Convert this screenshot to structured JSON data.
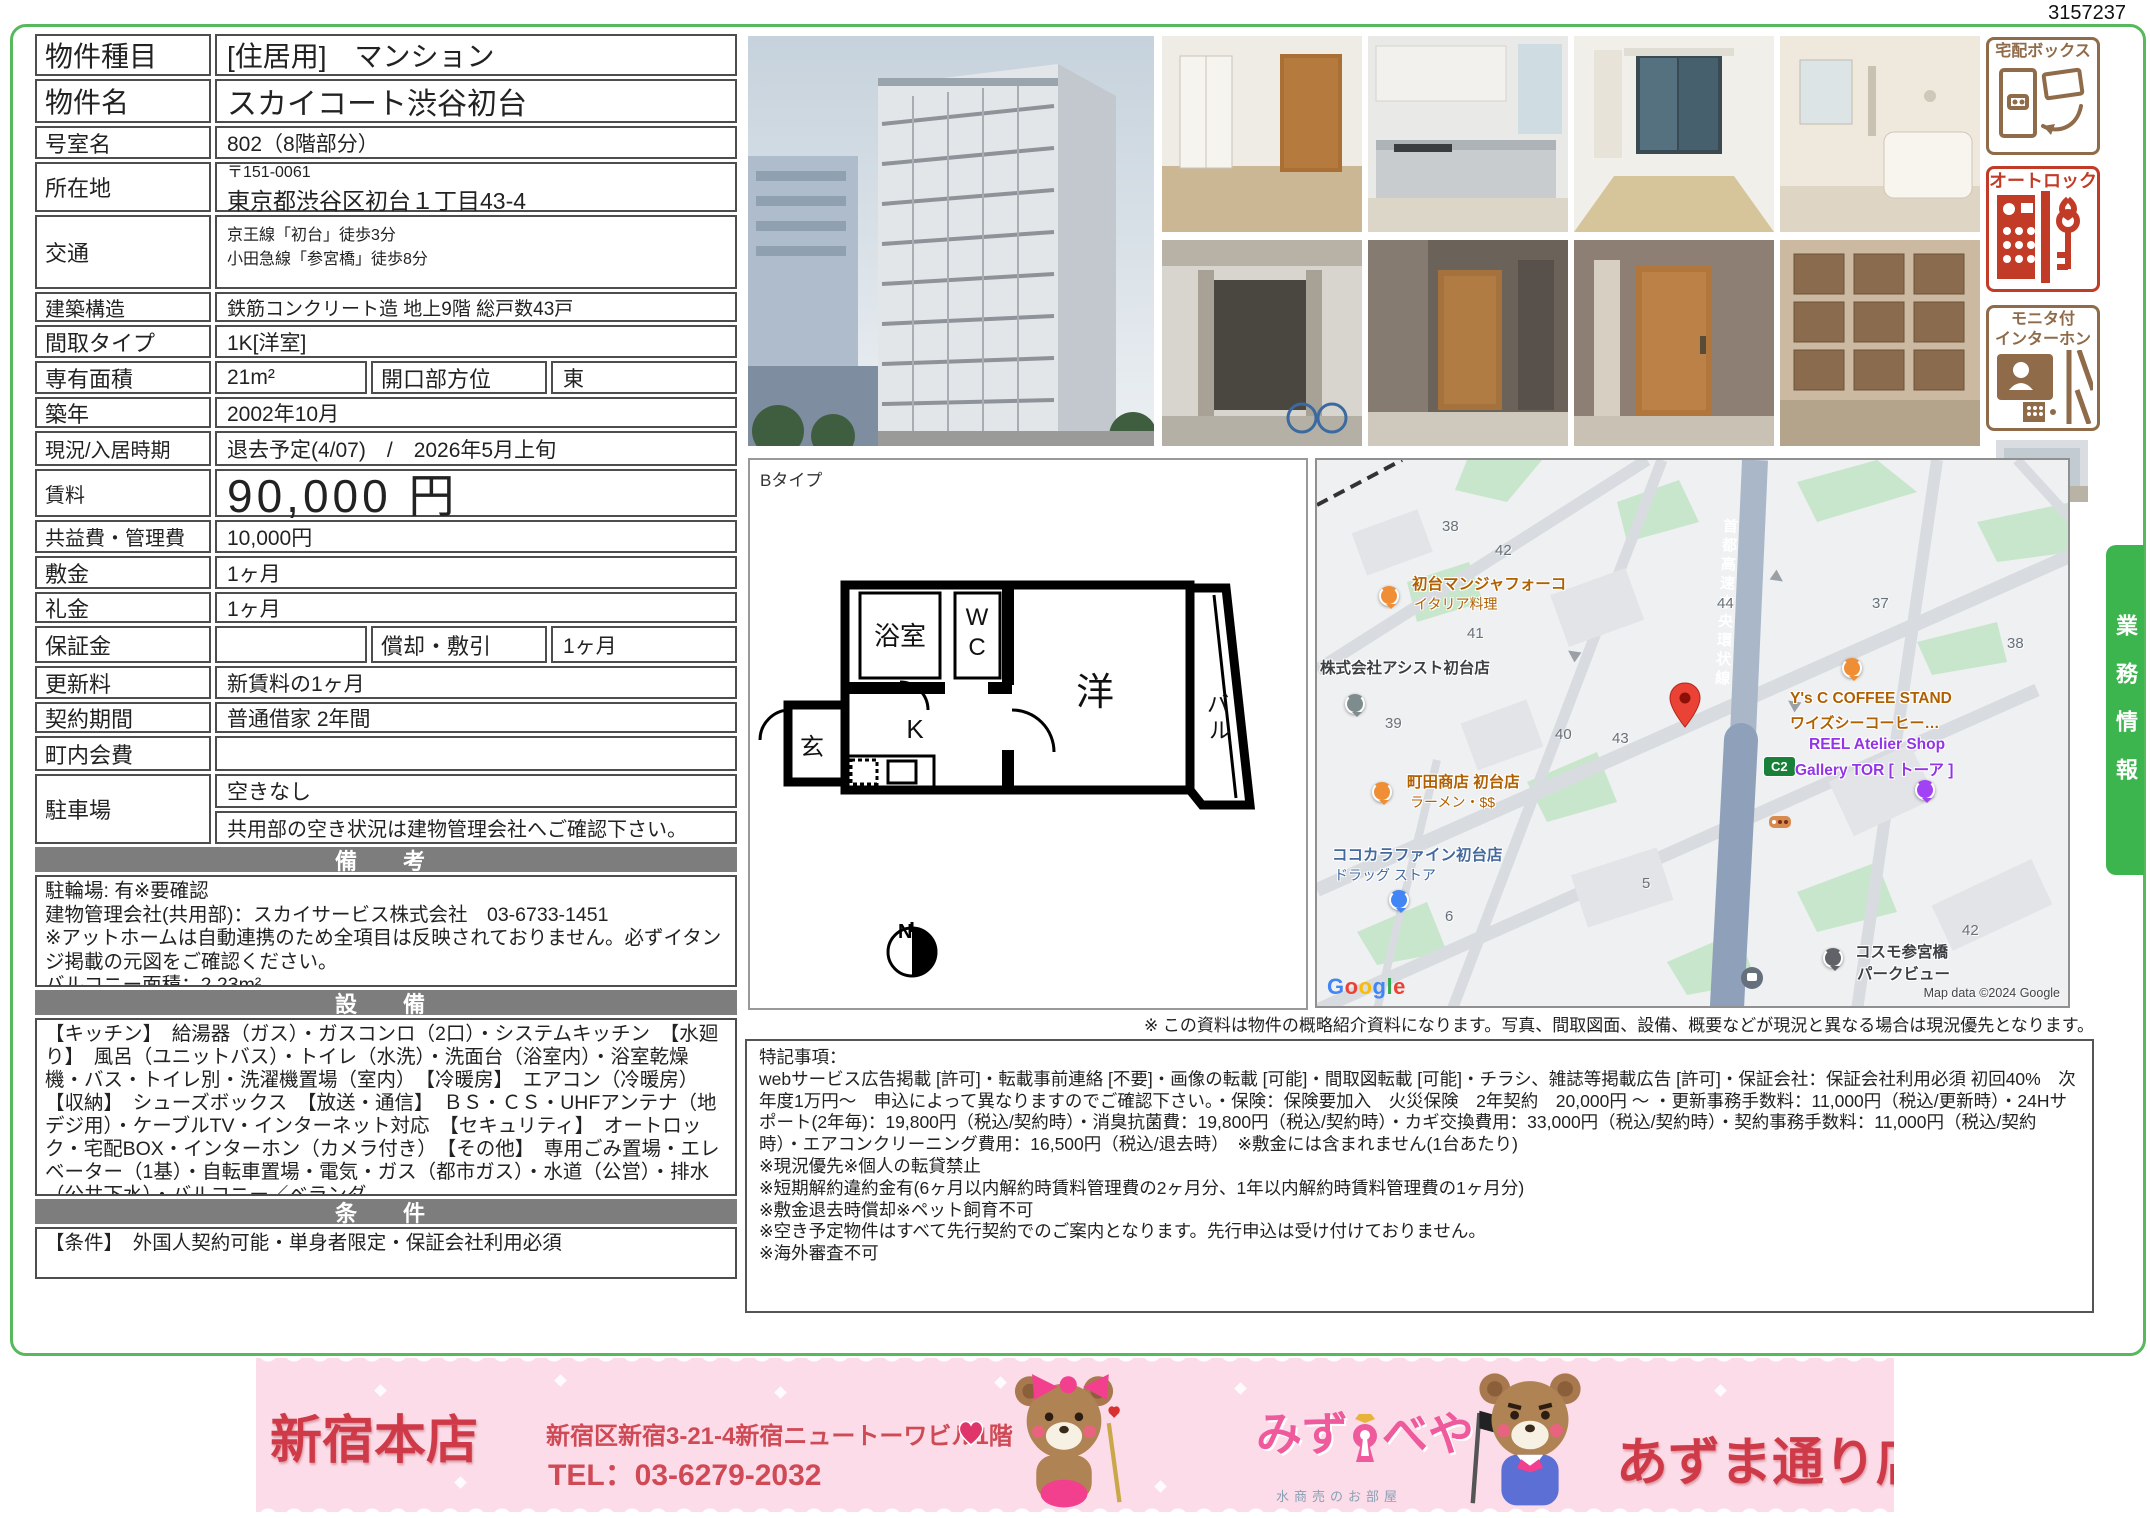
{
  "page": {
    "doc_number": "3157237",
    "business_tab": "業務情報",
    "map_note": "※ この資料は物件の概略紹介資料になります。写真、間取図面、設備、概要などが現況と異なる場合は現況優先となります。"
  },
  "table": {
    "property_type_label": "物件種目",
    "property_type": "[住居用]　マンション",
    "property_name_label": "物件名",
    "property_name": "スカイコート渋谷初台",
    "room_label": "号室名",
    "room": "802（8階部分）",
    "address_label": "所在地",
    "postal": "〒151-0061",
    "address": "東京都渋谷区初台１丁目43-4",
    "access_label": "交通",
    "access1": "京王線「初台」徒歩3分",
    "access2": "小田急線「参宮橋」徒歩8分",
    "structure_label": "建築構造",
    "structure": "鉄筋コンクリート造 地上9階 総戸数43戸",
    "layout_label": "間取タイプ",
    "layout": "1K[洋室]",
    "area_label": "専有面積",
    "area": "21m²",
    "facing_label": "開口部方位",
    "facing": "東",
    "built_label": "築年",
    "built": "2002年10月",
    "status_label": "現況/入居時期",
    "status": "退去予定(4/07)　/　2026年5月上旬",
    "rent_label": "賃料",
    "rent": "90,000 円",
    "fee_label": "共益費・管理費",
    "fee": "10,000円",
    "deposit_label": "敷金",
    "deposit": "1ヶ月",
    "key_money_label": "礼金",
    "key_money": "1ヶ月",
    "guarantee_label": "保証金",
    "guarantee": "",
    "amortization_label": "償却・敷引",
    "amortization": "1ヶ月",
    "renewal_label": "更新料",
    "renewal": "新賃料の1ヶ月",
    "contract_label": "契約期間",
    "contract": "普通借家 2年間",
    "association_label": "町内会費",
    "association": "",
    "parking_label": "駐車場",
    "parking1": "空きなし",
    "parking2": "共用部の空き状況は建物管理会社へご確認下さい。"
  },
  "sections": {
    "remarks_header": "備　考",
    "remarks_lines": [
      "駐輪場: 有※要確認",
      "建物管理会社(共用部)：スカイサービス株式会社　03-6733-1451",
      "※アットホームは自動連携のため全項目は反映されておりません。必ずイタンジ掲載の元図をご確認ください。",
      "バルコニー面積：2.23m²"
    ],
    "equipment_header": "設　備",
    "equipment_text": "【キッチン】　給湯器（ガス）・ガスコンロ（2口）・システムキッチン　【水廻り】　風呂（ユニットバス）・トイレ（水洗）・洗面台（浴室内）・浴室乾燥機・バス・トイレ別・洗濯機置場（室内）　【冷暖房】　エアコン（冷暖房）　【収納】　シューズボックス　【放送・通信】　ＢＳ・ＣＳ・UHFアンテナ（地デジ用）・ケーブルTV・インターネット対応　【セキュリティ】　オートロック・宅配BOX・インターホン（カメラ付き）　【その他】　専用ごみ置場・エレベーター（1基）・自転車置場・電気・ガス（都市ガス）・水道（公営）・排水（公共下水）・バルコニー／ベランダ",
    "conditions_header": "条　件",
    "conditions_text": "【条件】　外国人契約可能・単身者限定・保証会社利用必須"
  },
  "floorplan": {
    "type": "Bタイプ",
    "bath": "浴室",
    "wc": "WC",
    "entrance": "玄",
    "kitchen": "K",
    "room": "洋",
    "balcony": "バル",
    "compass": "N"
  },
  "badges": {
    "delivery": "宅配ボックス",
    "delivery_color": "#8f6b4a",
    "autolock": "オートロック",
    "autolock_color": "#c23b27",
    "intercom1": "モニタ付",
    "intercom2": "インターホン",
    "intercom_color": "#8f6b4a"
  },
  "map": {
    "highway": "首都高速中央環状線",
    "badge": "C2",
    "google_letters": [
      "G",
      "o",
      "o",
      "g",
      "l",
      "e"
    ],
    "copyright": "Map data ©2024 Google",
    "blocks": [
      "38",
      "42",
      "44",
      "37",
      "41",
      "38",
      "39",
      "40",
      "43",
      "5",
      "6",
      "42"
    ],
    "pois": {
      "manja": "初台マンジャフォーコ",
      "manja_sub": "イタリア料理",
      "assist": "株式会社アシスト初台店",
      "ysc": "Y's C COFFEE STAND",
      "ysc_sub": "ワイズシーコーヒー…",
      "reel": "REEL Atelier Shop",
      "reel_sub": "Gallery TOR [ トーア ]",
      "machida": "町田商店 初台店",
      "machida_sub": "ラーメン・$$",
      "cocokara": "ココカラファイン初台店",
      "cocokara_sub": "ドラッグ ストア",
      "cosmo": "コスモ参宮橋",
      "cosmo_sub": "パークビュー"
    }
  },
  "notes": {
    "title": "特記事項：",
    "lines": [
      "webサービス広告掲載 [許可]・転載事前連絡 [不要]・画像の転載 [可能]・間取図転載 [可能]・チラシ、雑誌等掲載広告 [許可]・保証会社：保証会社利用必須 初回40%　次年度1万円〜　申込によって異なりますのでご確認下さい。・保険：保険要加入　火災保険　2年契約　20,000円 〜 ・更新事務手数料：11,000円（税込/更新時）・24Hサポート(2年毎)：19,800円（税込/契約時）・消臭抗菌費：19,800円（税込/契約時）・カギ交換費用：33,000円（税込/契約時）・契約事務手数料：11,000円（税込/契約時）・エアコンクリーニング費用：16,500円（税込/退去時）　※敷金には含まれません(1台あたり)",
      "※現況優先※個人の転貸禁止",
      "※短期解約違約金有(6ヶ月以内解約時賃料管理費の2ヶ月分、1年以内解約時賃料管理費の1ヶ月分)",
      "※敷金退去時償却※ペット飼育不可",
      "※空き予定物件はすべて先行契約でのご案内となります。先行申込は受け付けておりません。",
      "※海外審査不可"
    ]
  },
  "footer": {
    "shop1_name": "新宿本店",
    "shop1_address": "新宿区新宿3-21-4新宿ニュートーワビル1階",
    "shop1_tel": "TEL：03-6279-2032",
    "logo_pre": "みず",
    "logo_post": "べや",
    "logo_tagline": "水商売のお部屋",
    "shop2_name": "あずま通り店",
    "shop2_address": "新宿区歌舞伎町1-8-3良川ビル2階",
    "shop2_tel": "TEL：03-6205-5732"
  }
}
